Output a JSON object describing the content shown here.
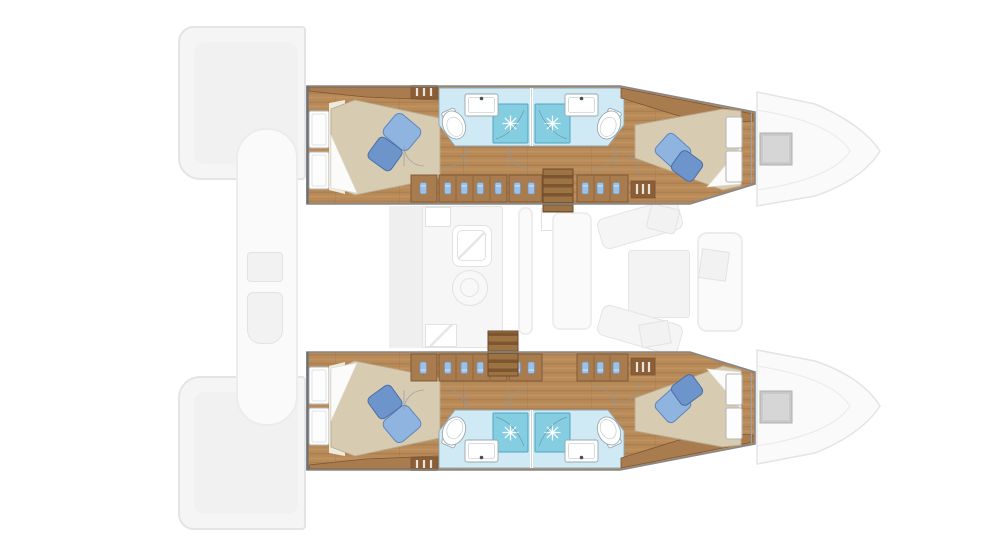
{
  "meta": {
    "description": "Top-down floor plan of a four-cabin sailing catamaran, bow pointing right. Both hulls are drawn in detail (wood cabin soles, beige double berths with blue pillows, light-blue bathrooms with shower stalls, toilets and basins, wardrobes with hanging clothes, companionway steps). The central saloon, aft cockpit, transoms and bow sections are drawn as faded grey outlines.",
    "view": "deck plan",
    "visible_text": []
  },
  "colors": {
    "canvas": "#ffffff",
    "hull_outline": "#84888c",
    "bulkhead": "#6e7276",
    "wood_floor": "#b78a58",
    "wood_plank_line": "#a3774a",
    "wood_cabinet": "#a87c4f",
    "wood_cabinet_dark": "#8a5f38",
    "wood_edge": "#7d5633",
    "bed_linen": "#d7cbb2",
    "bed_linen_edge": "#b8aa8e",
    "pillow_light": "#8fb4e0",
    "pillow_light_edge": "#5d86bd",
    "pillow_dark": "#6d95cb",
    "pillow_dark_edge": "#4a6fa8",
    "bath_floor": "#cfeaf4",
    "bath_wall": "#93a6ae",
    "shower_fill": "#85cde1",
    "shower_edge": "#4da7c0",
    "fixture_edge": "#9aa7ad",
    "window_frame": "#b4b8ba",
    "cloth_blue": "#9cc0e6",
    "cloth_edge": "#6d94bf",
    "vent_slat": "#e8e4da",
    "arc_line": "#8b9aa2",
    "ghost_fill": "#f5f5f5",
    "ghost_fill_light": "#fafafa",
    "ghost_edge": "#e4e4e4",
    "hatch_fill": "#c9c9c9",
    "hatch_edge": "#aeaeae",
    "hatch_inner": "#d6d6d6"
  },
  "hulls": [
    {
      "id": "upper-hull",
      "position": "top",
      "rooms": [
        "aft double cabin",
        "aft shower room with WC and basin",
        "forward shower room with WC and basin",
        "forward double cabin"
      ],
      "features": [
        "double berth with two blue pillows (aft)",
        "double berth with two blue pillows (forward)",
        "two hull windows per cabin",
        "wardrobes with hanging clothes along inboard side",
        "louvre vents",
        "companionway steps to saloon",
        "door swing arcs",
        "bow deck hatch (faded)"
      ]
    },
    {
      "id": "lower-hull",
      "position": "bottom",
      "rooms": [
        "aft double cabin",
        "aft shower room with WC and basin",
        "forward shower room with WC and basin",
        "forward double cabin"
      ],
      "features": [
        "double berth with two blue pillows (aft)",
        "double berth with two blue pillows (forward)",
        "two hull windows per cabin",
        "wardrobes with hanging clothes along inboard side",
        "louvre vents",
        "companionway steps to saloon",
        "door swing arcs",
        "bow deck hatch (faded)"
      ]
    }
  ],
  "saloon": {
    "rendered": "faded outline",
    "features": [
      "galley counter",
      "galley sink",
      "stove",
      "refrigerator",
      "oven",
      "mast post",
      "dinette bench seats",
      "saloon table",
      "chaise seat"
    ]
  },
  "exterior": {
    "rendered": "faded outline",
    "features": [
      "port transom swim platform",
      "starboard transom swim platform",
      "aft cockpit bench",
      "cockpit console",
      "cockpit locker",
      "bow sections",
      "two grey deck hatches"
    ]
  }
}
